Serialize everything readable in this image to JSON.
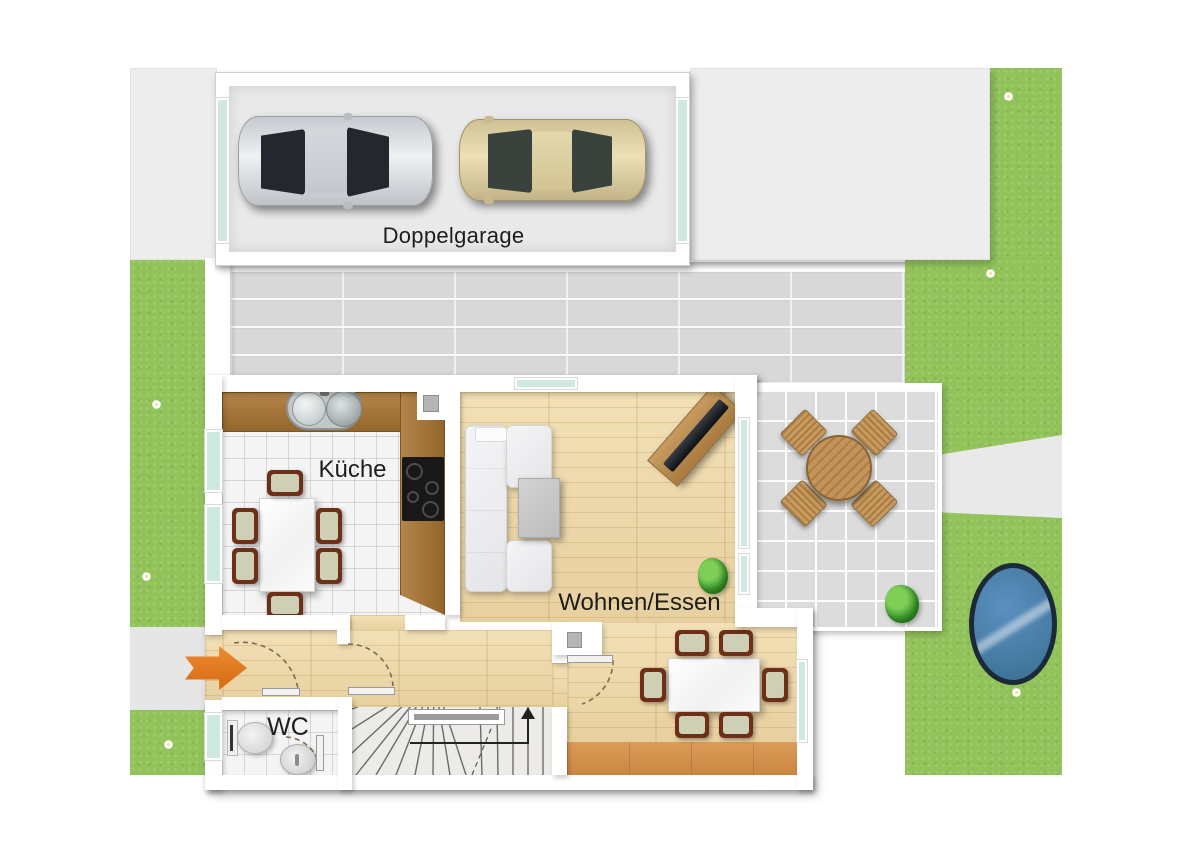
{
  "floorplan": {
    "rooms": {
      "garage": {
        "label": "Doppelgarage"
      },
      "kitchen": {
        "label": "Küche"
      },
      "living_dining": {
        "label": "Wohnen/Essen"
      },
      "wc": {
        "label": "WC"
      }
    },
    "colors": {
      "lawn": "#92c35b",
      "driveway": "#ededed",
      "courtyard_pavers": "#d8d8d8",
      "terrace_tiles": "#dcdcdc",
      "wood_floor": "#eed9ab",
      "wood_accent": "#d3924e",
      "counter_wood": "#a87a3e",
      "window_glass": "#cfe9df",
      "wall": "#ffffff",
      "entrance_arrow": "#e0761f",
      "pond_water": "#4a80b5",
      "chair_frame": "#6d2f17",
      "chair_seat": "#cdd0b4",
      "car_silver": "#d8dbdf",
      "car_beige": "#dccfa0"
    },
    "icons": {
      "entrance_arrow": "entrance-direction-arrow",
      "stairs_arrow": "stairs-up-arrow"
    }
  }
}
